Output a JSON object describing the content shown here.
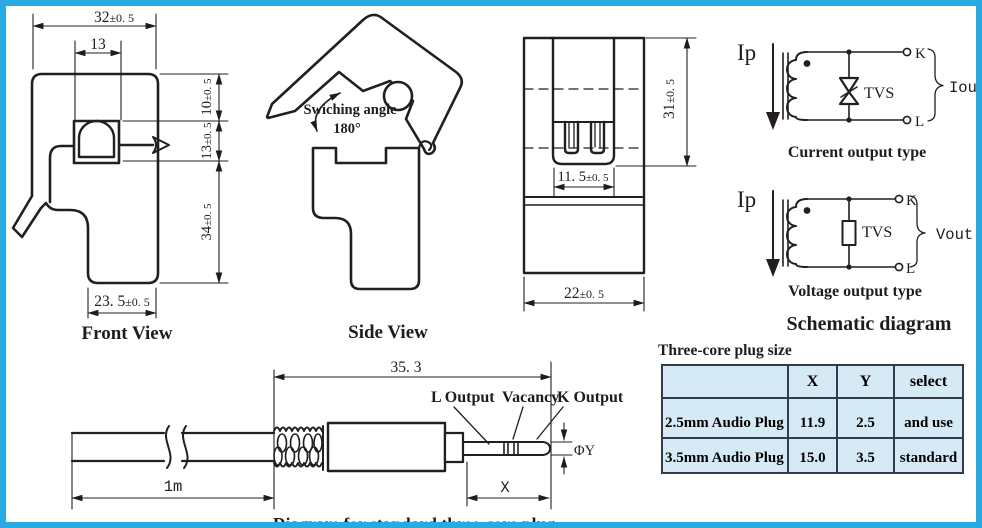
{
  "frame": {
    "border_color": "#29abe2"
  },
  "front_view": {
    "title": "Front View",
    "dim_top": {
      "v": "32",
      "t": "±0. 5"
    },
    "dim_window_w": {
      "v": "13",
      "t": ""
    },
    "dim_h10": {
      "v": "10",
      "t": "±0. 5"
    },
    "dim_h13": {
      "v": "13",
      "t": "±0. 5"
    },
    "dim_h34": {
      "v": "34",
      "t": "±0. 5"
    },
    "dim_bottom": {
      "v": "23. 5",
      "t": "±0. 5"
    }
  },
  "side_view": {
    "title": "Side View",
    "angle_label": "Swiching angle",
    "angle_value": "180°"
  },
  "back_view": {
    "dim_height": {
      "v": "31",
      "t": "±0. 5"
    },
    "dim_slot": {
      "v": "11. 5",
      "t": "±0. 5"
    },
    "dim_width": {
      "v": "22",
      "t": "±0. 5"
    }
  },
  "schematic": {
    "section_title": "Schematic diagram",
    "current": {
      "input_label": "Ip",
      "tvs_label": "TVS",
      "terminal_top": "K",
      "terminal_bottom": "L",
      "output_label": "Iout",
      "caption": "Current output type"
    },
    "voltage": {
      "input_label": "Ip",
      "tvs_label": "TVS",
      "terminal_top": "K",
      "terminal_bottom": "L",
      "output_label": "Vout",
      "caption": "Voltage output type"
    }
  },
  "plug_table": {
    "title": "Three-core plug size",
    "col_blank": "",
    "col_x": "X",
    "col_y": "Y",
    "col_select": "select",
    "rows": [
      {
        "name": "2.5mm Audio Plug",
        "x": "11.9",
        "y": "2.5",
        "select": "and use"
      },
      {
        "name": "3.5mm Audio Plug",
        "x": "15.0",
        "y": "3.5",
        "select": "standard"
      }
    ]
  },
  "plug_diagram": {
    "caption": "Diagram for standard three-core plug",
    "dim_total": "35. 3",
    "dim_cable": "1m",
    "label_l": "L Output",
    "label_vacancy": "Vacancy",
    "label_k": "K Output",
    "dim_dia": "ΦY",
    "dim_x": "X"
  }
}
